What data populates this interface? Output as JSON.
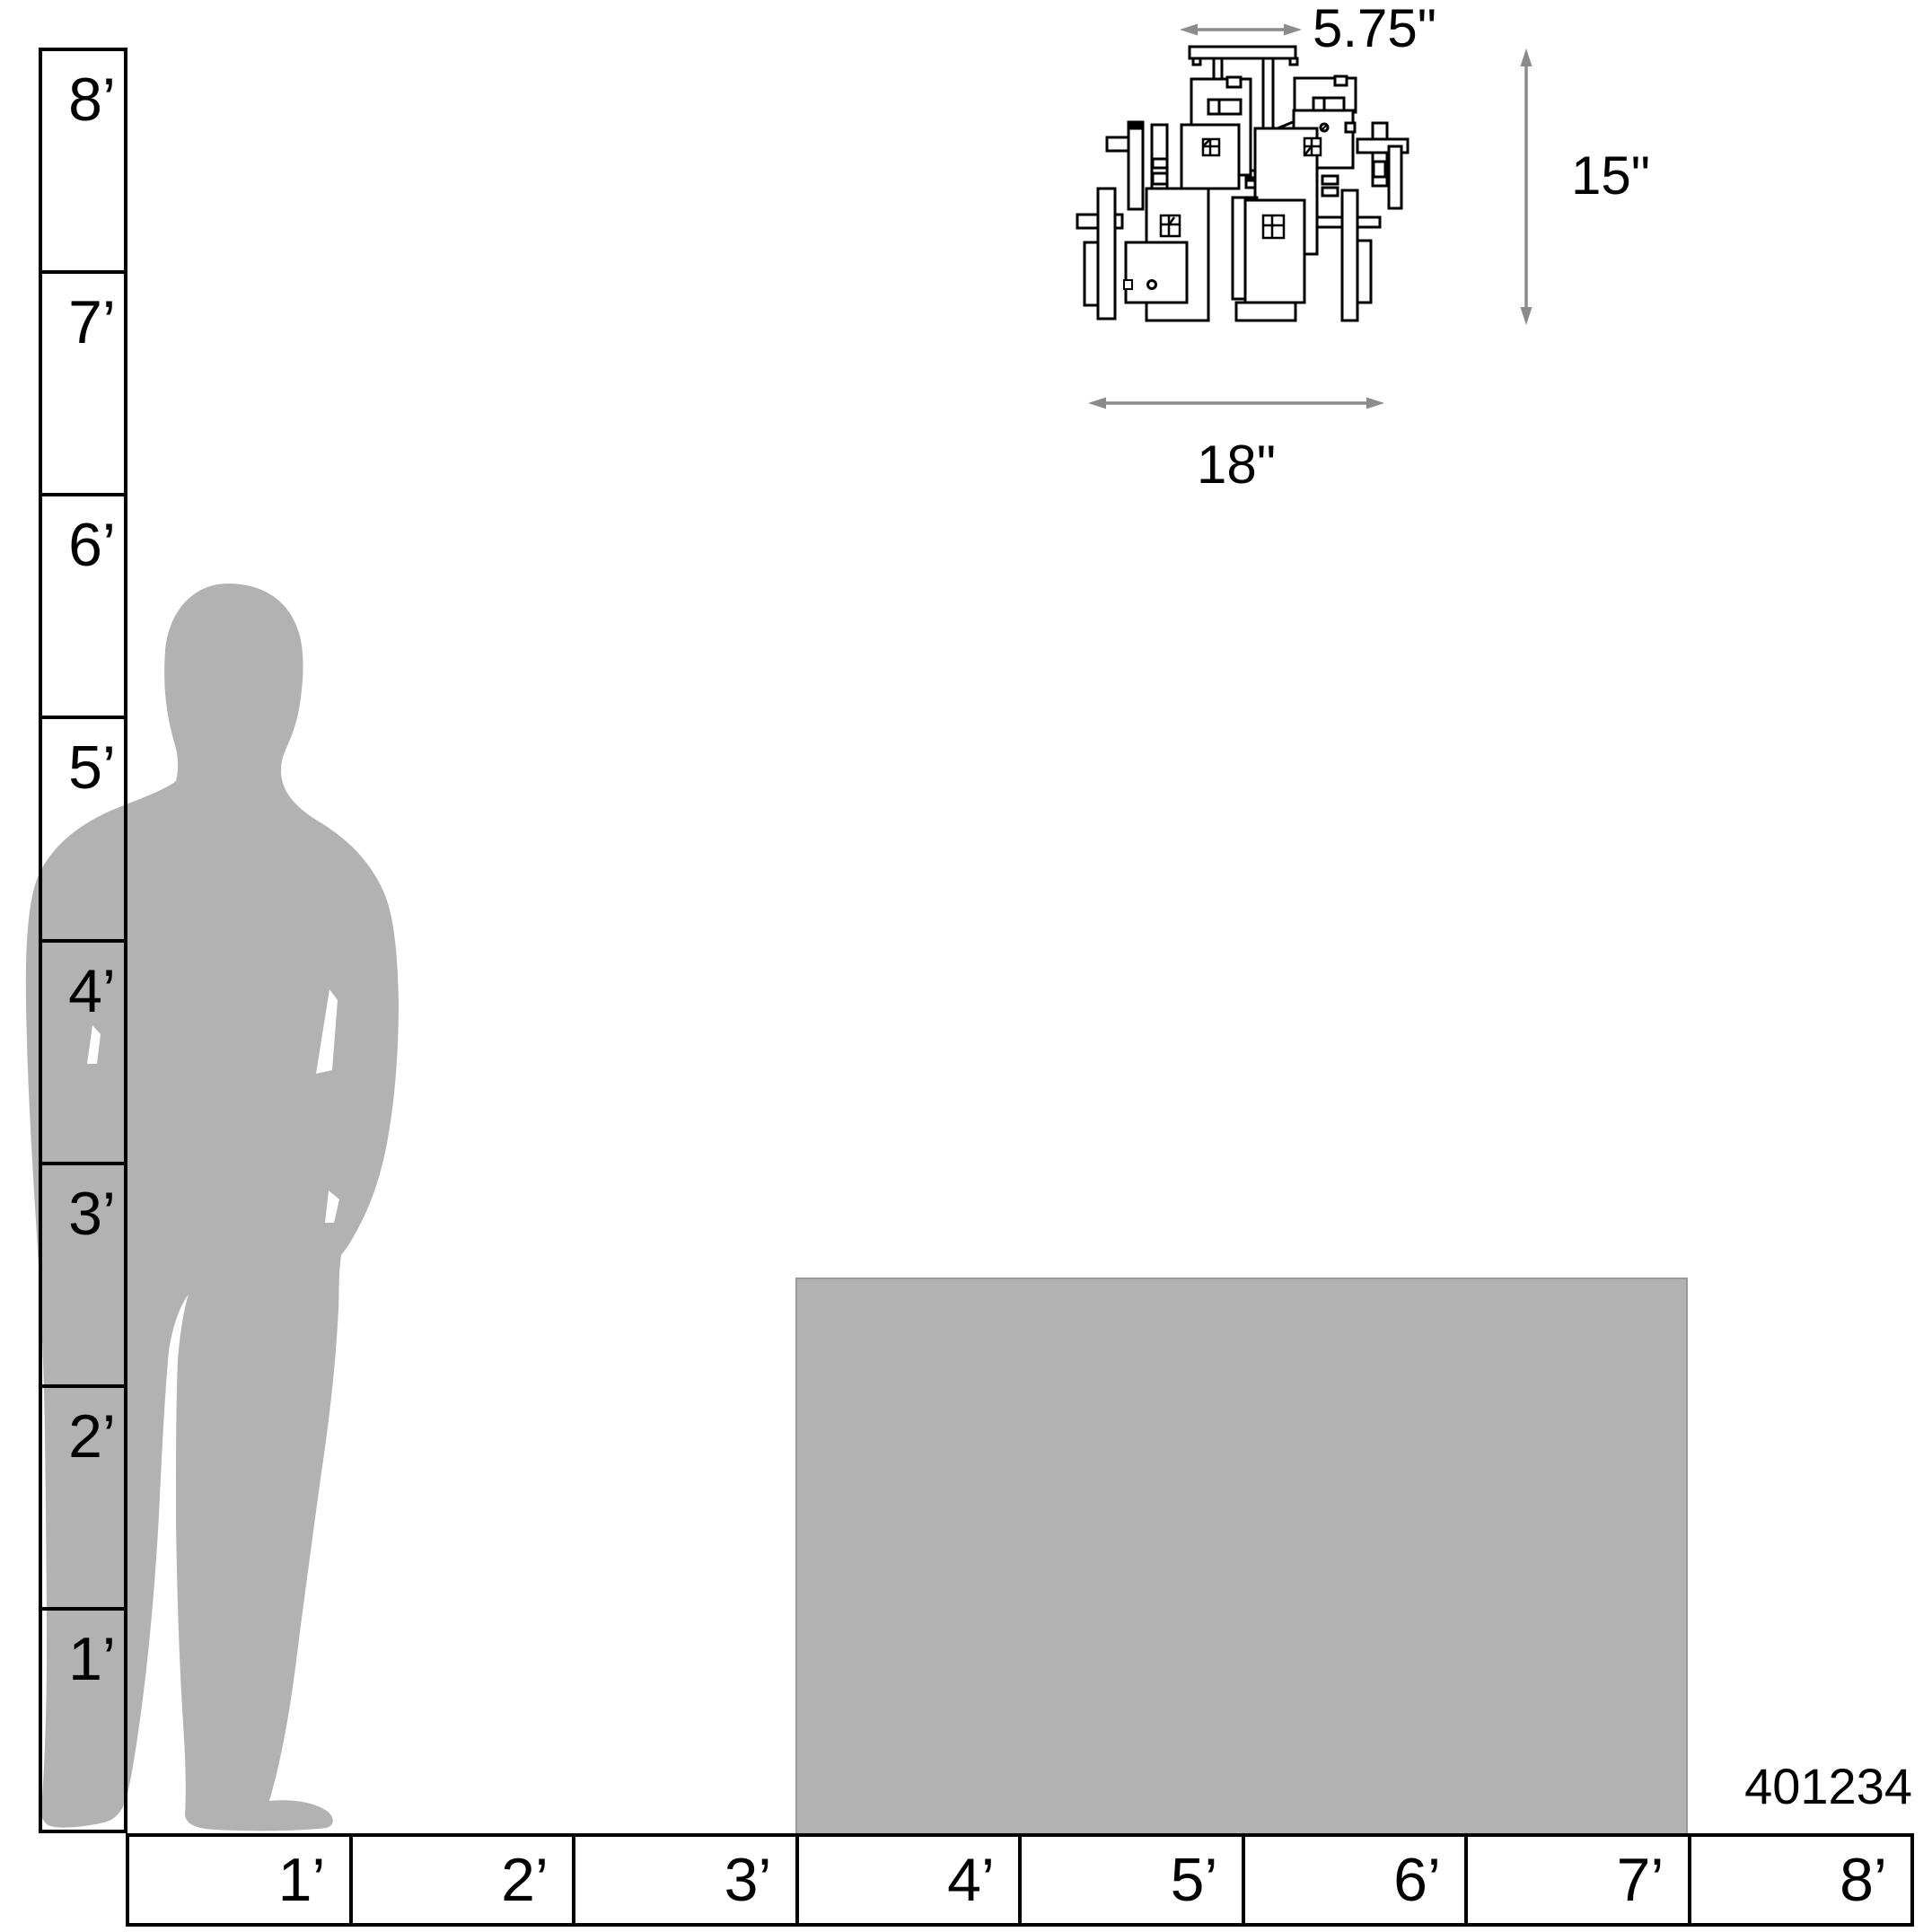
{
  "product": {
    "part_number": "401234"
  },
  "fixture": {
    "kind": "semi-flush-ceiling-light-line-drawing",
    "canopy_width_label": "5.75\"",
    "height_label": "15\"",
    "width_label": "18\""
  },
  "rulers": {
    "unit": "feet",
    "vertical_feet": [
      "8’",
      "7’",
      "6’",
      "5’",
      "4’",
      "3’",
      "2’",
      "1’"
    ],
    "horizontal_feet": [
      "1’",
      "2’",
      "3’",
      "4’",
      "5’",
      "6’",
      "7’",
      "8’"
    ]
  },
  "scale_references": {
    "person": "standing-man-silhouette",
    "box": "gray-reference-box"
  },
  "colors": {
    "silhouette_gray": "#b2b2b2",
    "box_gray": "#b2b2b2",
    "box_border": "#9a9a9a",
    "arrow_gray": "#8b8b8b",
    "ink": "#000000",
    "background": "#ffffff"
  }
}
